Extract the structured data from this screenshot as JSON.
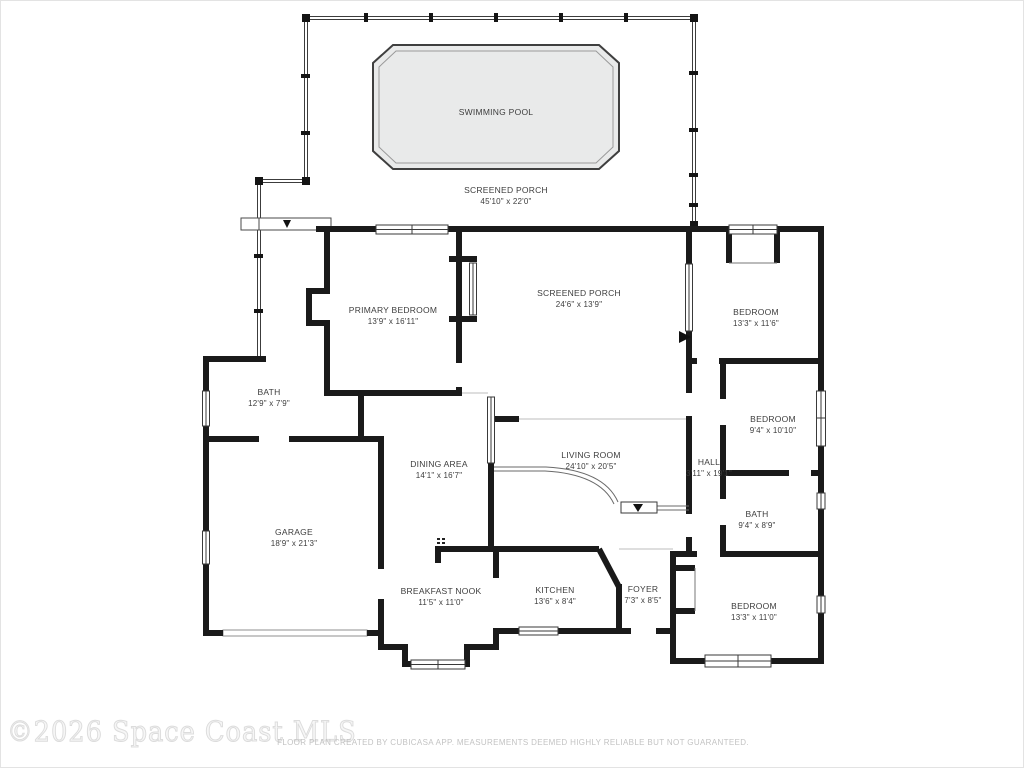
{
  "title": "Residential floor plan",
  "rooms": {
    "swimming_pool": {
      "name": "SWIMMING POOL",
      "dims": ""
    },
    "screened_porch_pool": {
      "name": "SCREENED PORCH",
      "dims": "45'10\" x 22'0\""
    },
    "primary_bedroom": {
      "name": "PRIMARY BEDROOM",
      "dims": "13'9\" x 16'11\""
    },
    "screened_porch_inner": {
      "name": "SCREENED PORCH",
      "dims": "24'6\" x 13'9\""
    },
    "bedroom_ne": {
      "name": "BEDROOM",
      "dims": "13'3\" x 11'6\""
    },
    "bath_w": {
      "name": "BATH",
      "dims": "12'9\" x 7'9\""
    },
    "bedroom_e": {
      "name": "BEDROOM",
      "dims": "9'4\" x 10'10\""
    },
    "dining_area": {
      "name": "DINING AREA",
      "dims": "14'1\" x 16'7\""
    },
    "living_room": {
      "name": "LIVING ROOM",
      "dims": "24'10\" x 20'5\""
    },
    "hall": {
      "name": "HALL",
      "dims": "3'11\" x 19'1\""
    },
    "garage": {
      "name": "GARAGE",
      "dims": "18'9\" x 21'3\""
    },
    "bath_e": {
      "name": "BATH",
      "dims": "9'4\" x 8'9\""
    },
    "breakfast_nook": {
      "name": "BREAKFAST NOOK",
      "dims": "11'5\" x 11'0\""
    },
    "kitchen": {
      "name": "KITCHEN",
      "dims": "13'6\" x 8'4\""
    },
    "foyer": {
      "name": "FOYER",
      "dims": "7'3\" x 8'5\""
    },
    "bedroom_se": {
      "name": "BEDROOM",
      "dims": "13'3\" x 11'0\""
    }
  },
  "watermark": "©2026 Space Coast MLS",
  "disclaimer": "FLOOR PLAN CREATED BY CUBICASA APP. MEASUREMENTS DEEMED HIGHLY RELIABLE BUT NOT GUARANTEED.",
  "colors": {
    "wall": "#1a1a1a",
    "pool_fill": "#e9eaea",
    "label_text": "#3d3d3d",
    "disclaimer_text": "#c3c3c3",
    "watermark_text": "#dcdcdc"
  }
}
